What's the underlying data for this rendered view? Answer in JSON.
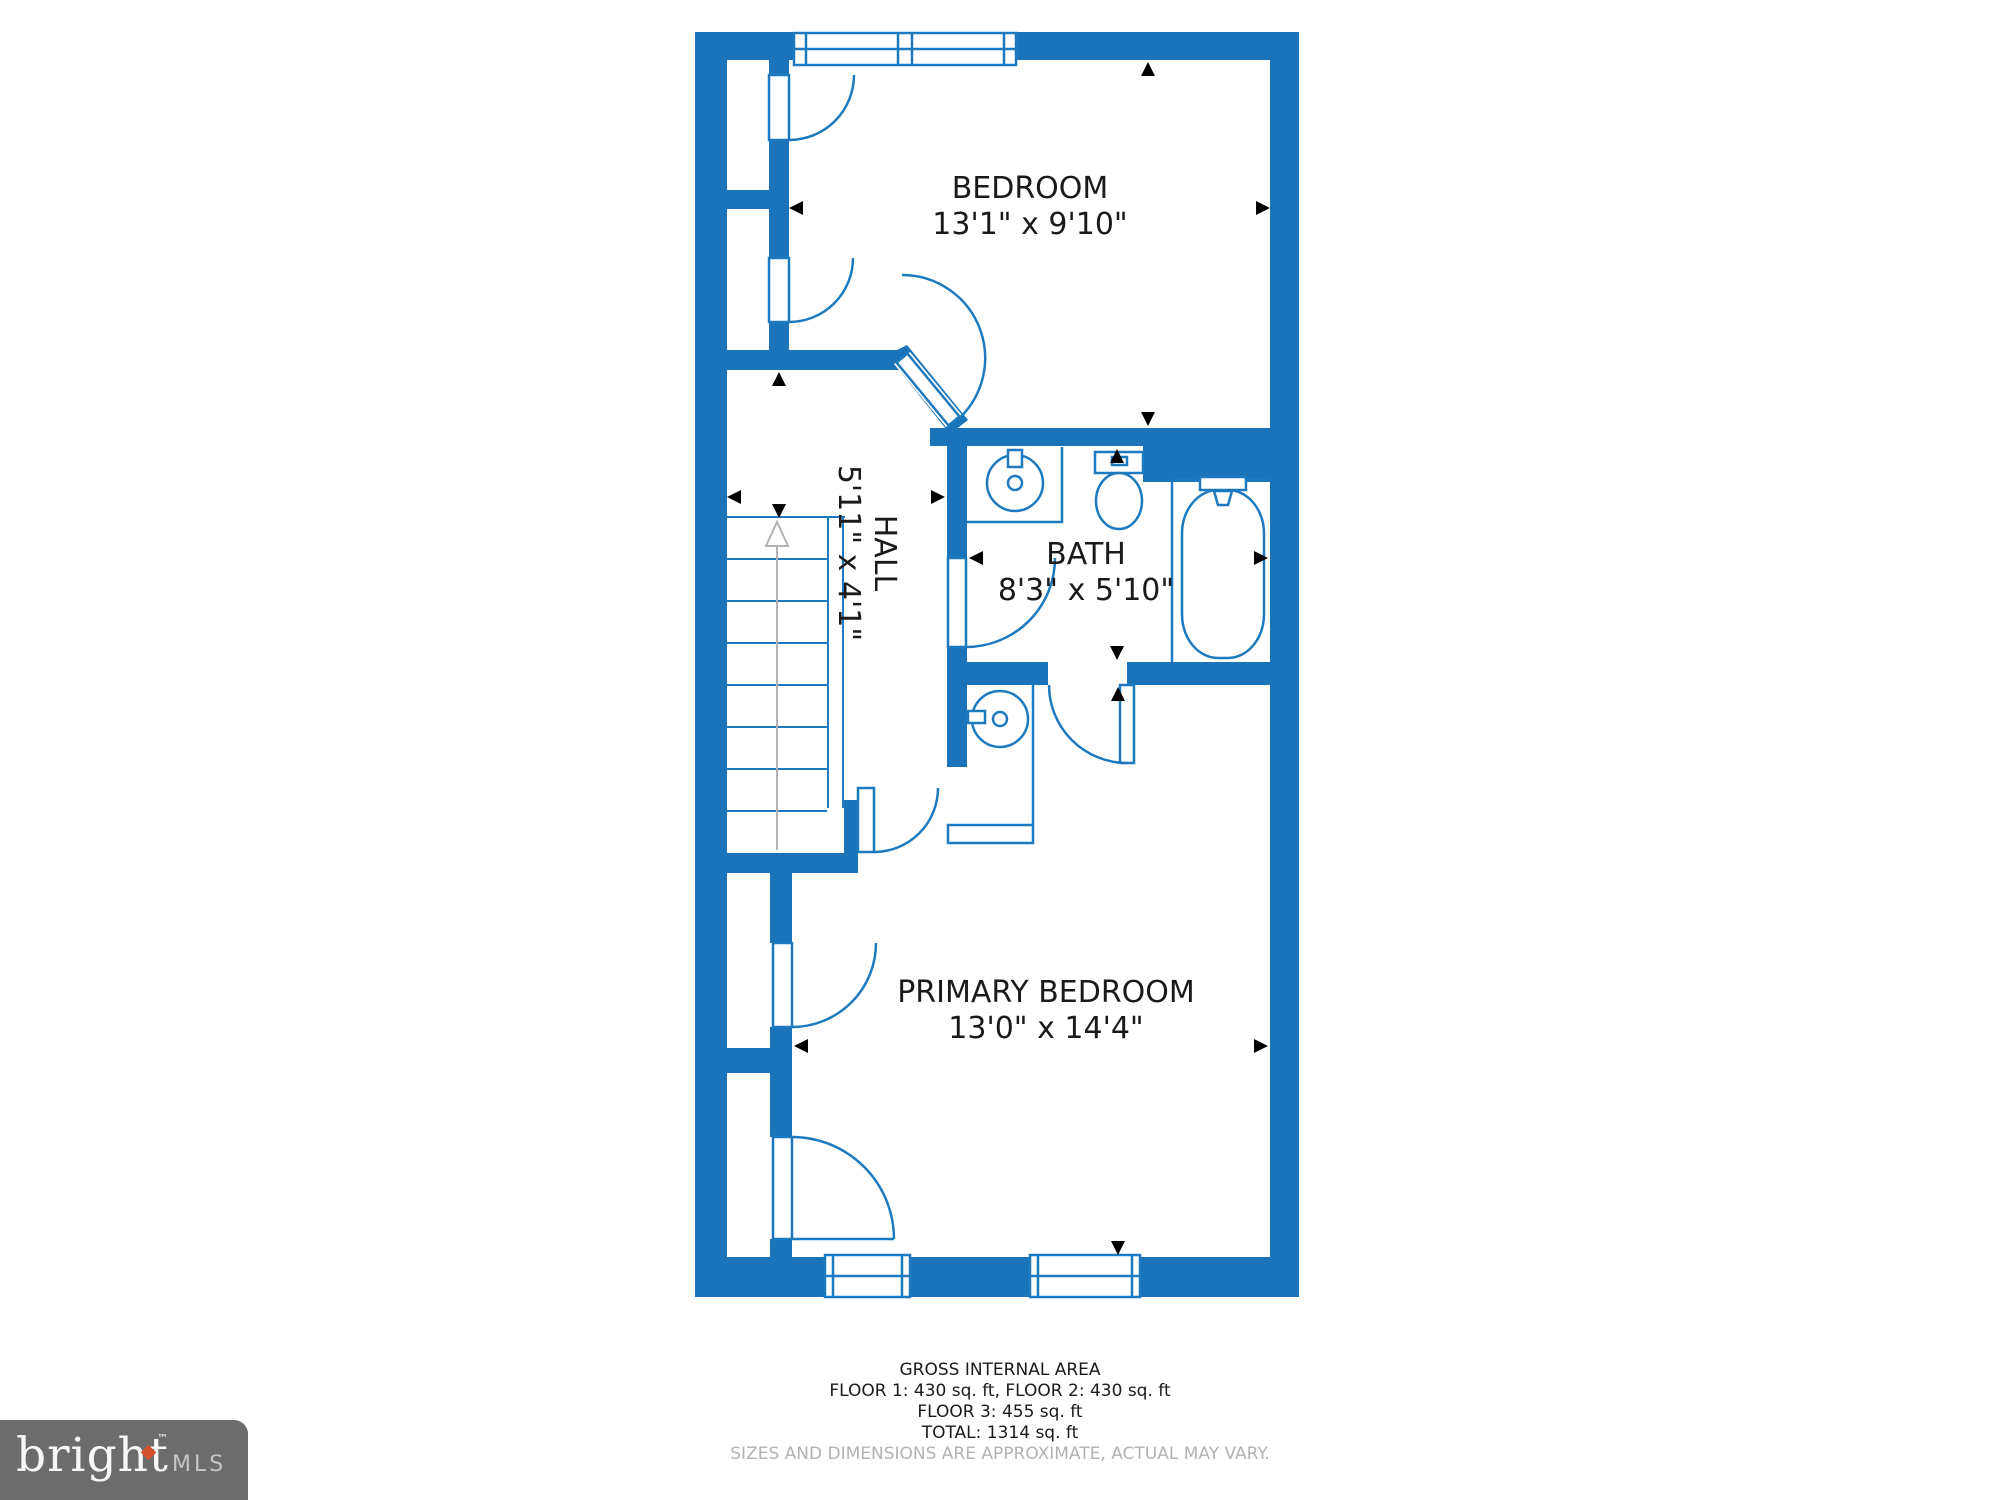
{
  "colors": {
    "wall_blue": "#1b74ba",
    "fixture_line": "#1e7abf",
    "label_text": "#1a1a1a",
    "muted_text": "#b2b2b2",
    "stairs_arrow_gray": "#b3b3b3",
    "logo_background": "#6c6c6c",
    "logo_accent": "#d4502b"
  },
  "rooms": {
    "bedroom": {
      "label": "BEDROOM",
      "dimensions": "13'1\" x 9'10\""
    },
    "hall": {
      "label": "HALL",
      "dimensions": "5'11\" x 4'1\""
    },
    "bath": {
      "label": "BATH",
      "dimensions": "8'3\" x 5'10\""
    },
    "primary_bedroom": {
      "label": "PRIMARY BEDROOM",
      "dimensions": "13'0\" x 14'4\""
    }
  },
  "footer": {
    "heading": "GROSS INTERNAL AREA",
    "floors_line": "FLOOR 1: 430 sq. ft, FLOOR 2: 430 sq. ft",
    "floor3_line": "FLOOR 3: 455 sq. ft",
    "total_line": "TOTAL: 1314 sq. ft",
    "disclaimer": "SIZES AND DIMENSIONS ARE APPROXIMATE, ACTUAL MAY VARY."
  },
  "logo": {
    "brand": "bright",
    "trademark": "TM",
    "suffix": "MLS"
  }
}
